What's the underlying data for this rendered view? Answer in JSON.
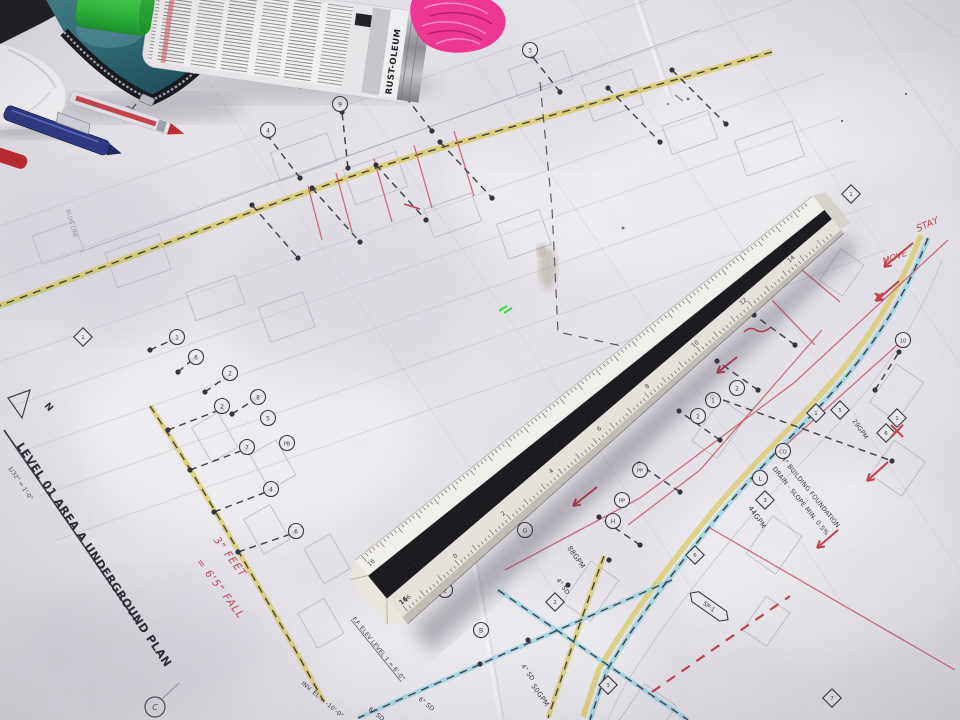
{
  "colors": {
    "highlight_yellow": "#d8c84e",
    "highlight_cyan": "#8fd2e0",
    "markup_red": "#c23b4a",
    "print_red": "#c75560",
    "ink": "#34343e",
    "cap_green": "#3ecb44",
    "mesh_pink": "#f0318e",
    "pouch_teal": "#2e6e79",
    "pen_blue": "#27337f",
    "pen_red": "#c0232b"
  },
  "can": {
    "brand": "RUST-OLEUM"
  },
  "ruler": {
    "numbers": [
      "16",
      "0",
      "2",
      "4",
      "6",
      "8",
      "10",
      "12",
      "14"
    ],
    "end_label": "16"
  },
  "plan": {
    "title": "LEVEL 01 AREA A UNDERGROUND PLAN",
    "scale_note": "1/32\" = 1'-0\"",
    "north_label": "N",
    "edge_label": "BLDG LINE",
    "labels": [
      {
        "t": "88GPM",
        "x": 567,
        "y": 548,
        "r": 55,
        "s": 7
      },
      {
        "t": "44GPM",
        "x": 748,
        "y": 508,
        "r": 55,
        "s": 7
      },
      {
        "t": "29GPM",
        "x": 852,
        "y": 421,
        "r": 55,
        "s": 6.2
      },
      {
        "t": "50GPM",
        "x": 531,
        "y": 686,
        "r": 55,
        "s": 7
      },
      {
        "t": "4\" SD",
        "x": 556,
        "y": 580,
        "r": 55,
        "s": 6.2
      },
      {
        "t": "4\" SD",
        "x": 521,
        "y": 666,
        "r": 55,
        "s": 6.2
      },
      {
        "t": "6\" SD",
        "x": 418,
        "y": 700,
        "r": 38,
        "s": 6.2
      },
      {
        "t": "6\" SD",
        "x": 368,
        "y": 710,
        "r": 38,
        "s": 6.2
      },
      {
        "t": "4\" BUILDING FOUNDATION",
        "x": 781,
        "y": 459,
        "r": 51,
        "s": 6.4
      },
      {
        "t": "DRAIN - SLOPE MIN. 0.5%",
        "x": 772,
        "y": 469,
        "r": 51,
        "s": 6.4
      },
      {
        "t": "F.F. ELEV LEVEL 1 = 6'-0\"",
        "x": 352,
        "y": 619,
        "r": 51,
        "s": 6,
        "u": true
      },
      {
        "t": "INV. EL = -10'-0\"",
        "x": 301,
        "y": 684,
        "r": 40,
        "s": 6
      }
    ],
    "circle_tags": [
      [
        177,
        337,
        "1"
      ],
      [
        196,
        357,
        "6"
      ],
      [
        230,
        373,
        "2"
      ],
      [
        258,
        397,
        "8"
      ],
      [
        268,
        418,
        "5"
      ],
      [
        287,
        443,
        "PB"
      ],
      [
        268,
        130,
        "4"
      ],
      [
        340,
        104,
        "9"
      ],
      [
        400,
        86,
        "7"
      ],
      [
        530,
        50,
        "3"
      ],
      [
        222,
        406,
        "2"
      ],
      [
        247,
        447,
        "7"
      ],
      [
        271,
        489,
        "4"
      ],
      [
        296,
        531,
        "6"
      ],
      [
        737,
        388,
        "2"
      ],
      [
        713,
        400,
        "1"
      ],
      [
        698,
        416,
        "2"
      ],
      [
        640,
        470,
        "PP"
      ],
      [
        622,
        500,
        "PP"
      ],
      [
        613,
        521,
        "H"
      ],
      [
        525,
        530,
        "G"
      ],
      [
        760,
        478,
        "L"
      ],
      [
        783,
        451,
        "CO"
      ],
      [
        903,
        340,
        "10"
      ],
      [
        445,
        590,
        "2"
      ],
      [
        481,
        630,
        "B"
      ]
    ],
    "diamond_tags": [
      [
        816,
        413,
        "1"
      ],
      [
        840,
        410,
        "5"
      ],
      [
        897,
        418,
        "1"
      ],
      [
        886,
        433,
        "6"
      ],
      [
        851,
        194,
        "1"
      ],
      [
        765,
        500,
        "3"
      ],
      [
        695,
        555,
        "6"
      ],
      [
        555,
        602,
        "2"
      ],
      [
        608,
        685,
        "3"
      ],
      [
        832,
        698,
        "7"
      ],
      [
        83,
        337,
        "1"
      ]
    ],
    "sp_tag": {
      "t": "SP-1",
      "x": 710,
      "y": 607,
      "r": 35
    },
    "grid_bubble": {
      "t": "C",
      "x": 155,
      "y": 707
    }
  },
  "redline": {
    "fall_note_1": "3\" FEET",
    "fall_note_2": "= 6'5\" FALL",
    "word_stay": "STAY",
    "word_move": "MOVE"
  }
}
